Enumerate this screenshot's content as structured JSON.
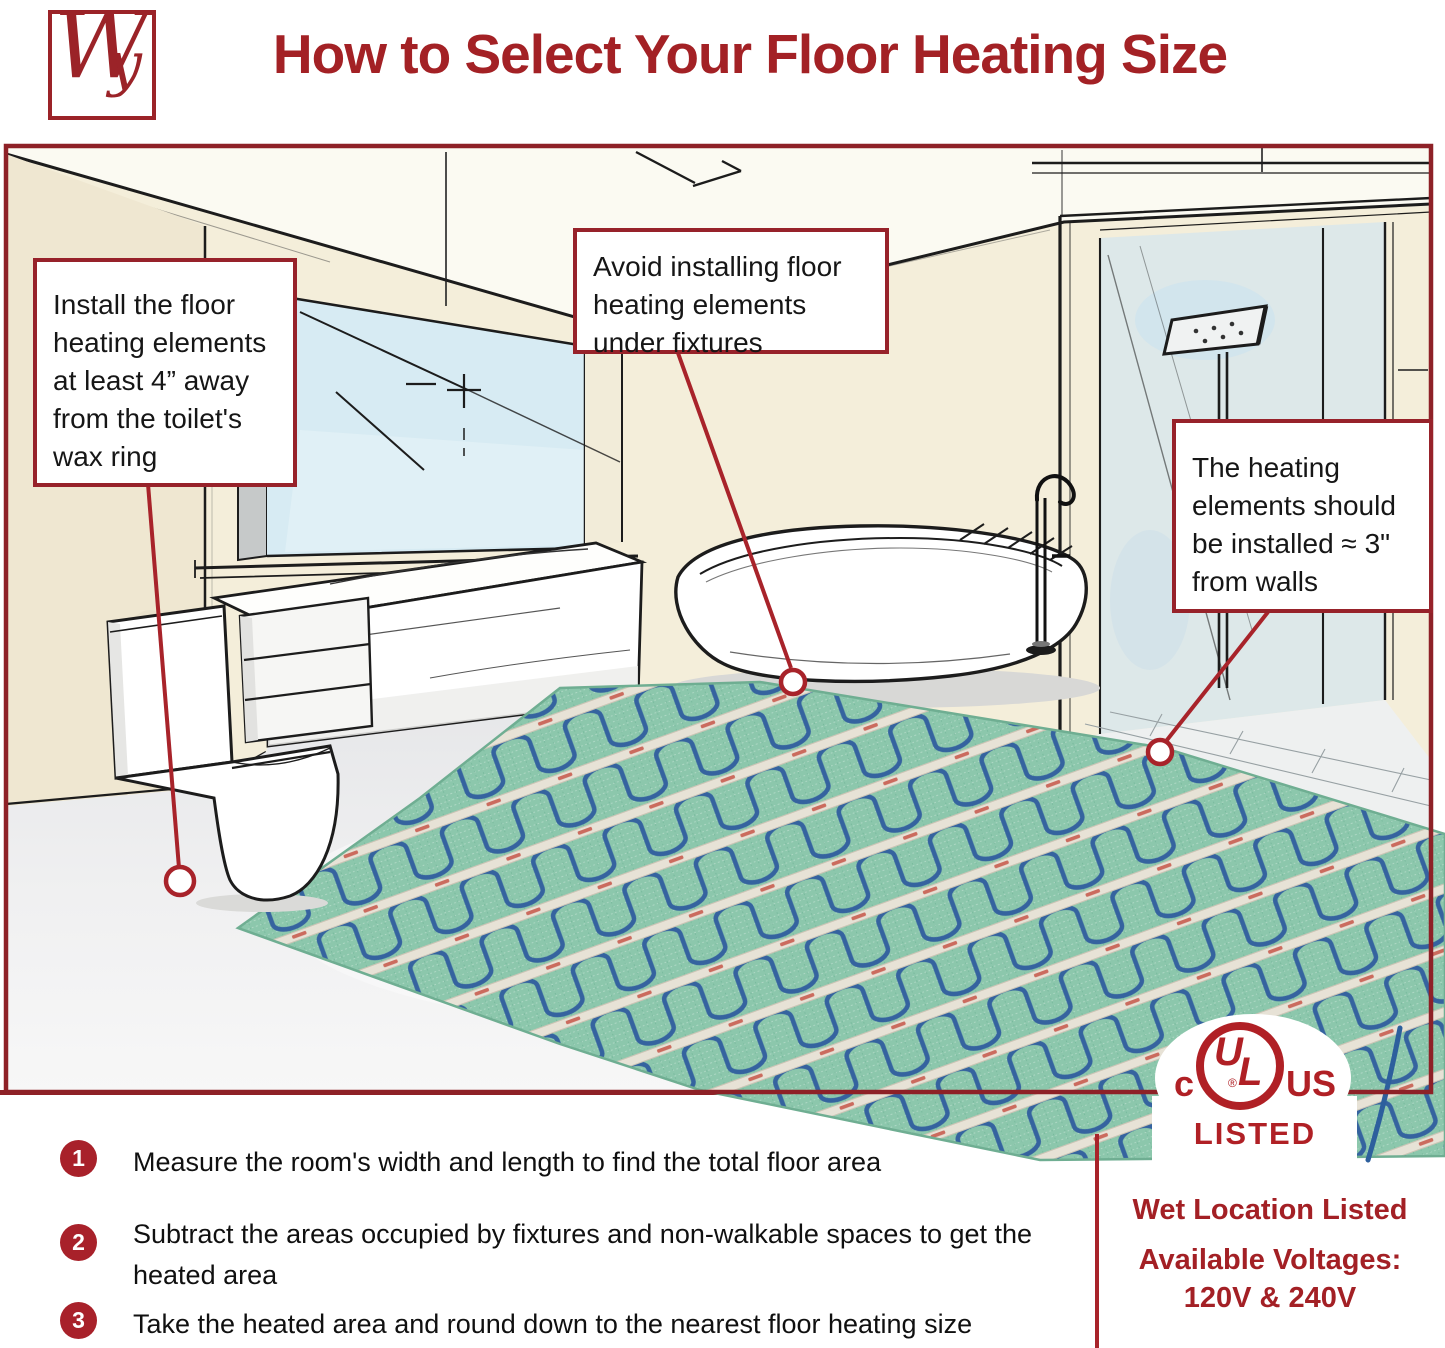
{
  "header": {
    "logo_w": "W",
    "logo_y": "y",
    "title": "How to Select Your Floor Heating Size"
  },
  "callouts": [
    {
      "id": "toilet",
      "text": "Install the floor heating elements at least 4” away from the toilet's wax ring"
    },
    {
      "id": "fixtures",
      "text": "Avoid installing floor heating elements under fixtures"
    },
    {
      "id": "walls",
      "text": "The heating elements should be installed ≈ 3\" from walls"
    }
  ],
  "steps": [
    {
      "num": "1",
      "text": "Measure the room's width and length to find the total floor area"
    },
    {
      "num": "2",
      "text": "Subtract the areas occupied by fixtures and non-walkable spaces to get the heated area"
    },
    {
      "num": "3",
      "text": "Take the heated area and round down to the nearest floor heating size"
    }
  ],
  "certification": {
    "c": "c",
    "u": "U",
    "l": "L",
    "us": "US",
    "registered": "®",
    "listed": "LISTED",
    "wet_location": "Wet Location Listed",
    "voltages_label": "Available Voltages:",
    "voltages_value": "120V & 240V"
  },
  "colors": {
    "accent_red": "#a32125",
    "frame_red": "#8e2127",
    "callout_border": "#97222a",
    "step_circle": "#a8212a",
    "badge_red": "#b02025",
    "mat_green": "#8cc7ac",
    "cable_blue": "#35639f",
    "wall_cream": "#f4eeda",
    "window_blue": "#d7ebf3"
  }
}
